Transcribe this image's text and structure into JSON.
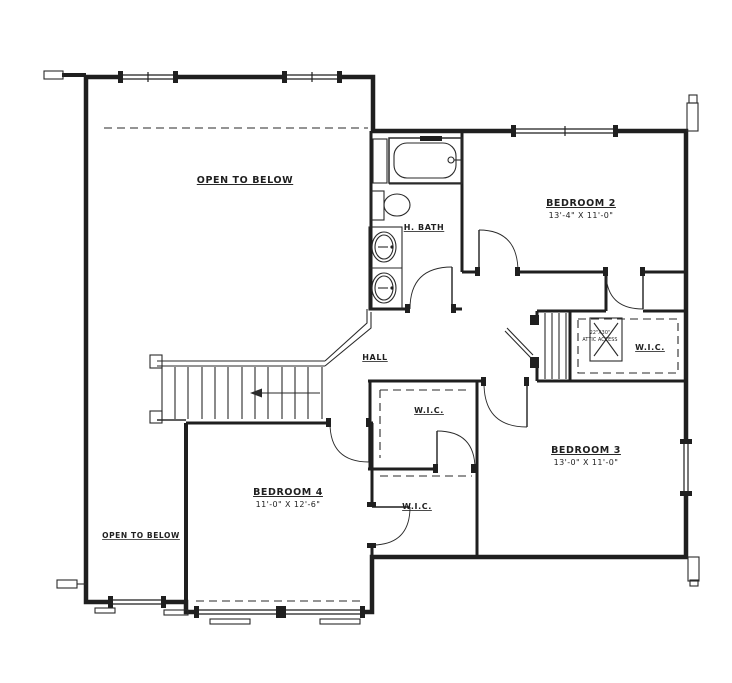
{
  "drawing": {
    "type": "second-floor-plan",
    "line_color": "#1f1f1f",
    "background_color": "#ffffff",
    "labels": {
      "open_below_top": "OPEN TO BELOW",
      "open_below_bottom": "OPEN TO BELOW",
      "hall": "HALL",
      "h_bath": "H. BATH",
      "wic_right": "W.I.C.",
      "wic_center": "W.I.C.",
      "wic_lower": "W.I.C.",
      "attic_line1": "22\"X30\"",
      "attic_line2": "ATTIC ACCESS"
    },
    "rooms": [
      {
        "name": "BEDROOM 2",
        "dims": "13'-4\" X 11'-0\""
      },
      {
        "name": "BEDROOM 3",
        "dims": "13'-0\" X 11'-0\""
      },
      {
        "name": "BEDROOM 4",
        "dims": "11'-0\" X 12'-6\""
      }
    ]
  }
}
